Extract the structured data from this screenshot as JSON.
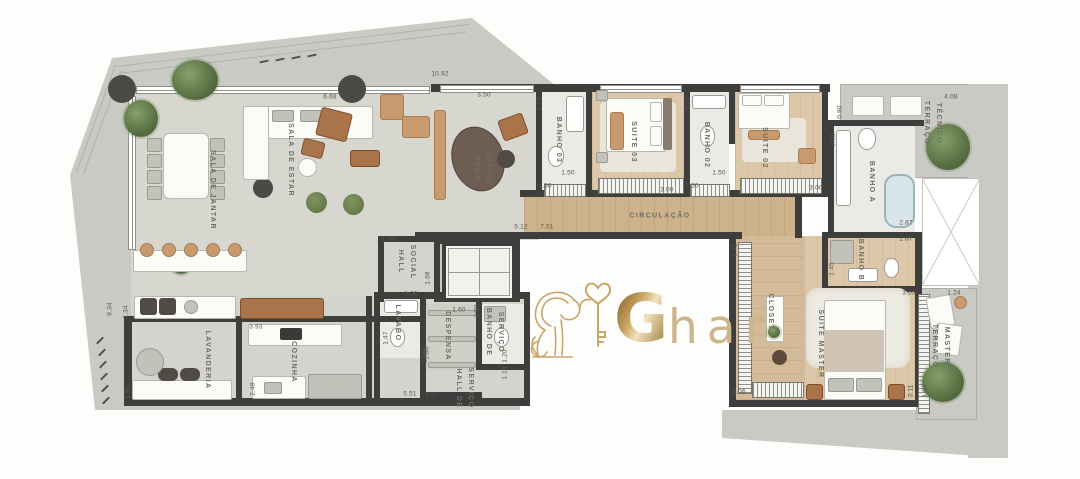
{
  "watermark": {
    "brand_g": "G",
    "brand_suffix": "har",
    "gold": "#c9a566"
  },
  "colors": {
    "wall": "#3e3e3c",
    "terrace": "#c9cac3",
    "floor": "#d7d7d0",
    "wood": "#cdb28b",
    "bath": "#eaeae6"
  },
  "rooms": {
    "sala_jantar": "SALA DE JANTAR",
    "sala_estar": "SALA DE ESTAR",
    "home_office": "HOME\nOFFICE",
    "banho_03": "BANHO 03",
    "suite_03": "SUITE 03",
    "banho_02": "BANHO 02",
    "suite_02": "SUITE 02",
    "circulacao": "CIRCULAÇÃO",
    "terraco_tecnico": "TERRAÇO\nTÉCNICO",
    "banho_a": "BANHO A",
    "banho_b": "BANHO B",
    "closet": "CLOSET",
    "suite_master": "SUITE MASTER",
    "terraco_master": "TERRAÇO\nMASTER",
    "hall_social": "HALL\nSOCIAL",
    "lavabo": "LAVABO",
    "lavanderia": "LAVANDERIA",
    "cozinha": "COZINHA",
    "despensa": "DESPENSA",
    "banho_servico": "BANHO DE\nSERVIÇO",
    "hall_servico": "HALL DE\nSERVIÇO"
  },
  "dims": {
    "d01": "10.92",
    "d02": "6.68",
    "d03": "3.50",
    "d04": "2.72",
    "d05": "2.72",
    "d06": "1.50",
    "d07": "1.50",
    "d08": "3.00",
    "d09": "1.50",
    "d10": "1.50",
    "d11": "3.00",
    "d12": "5.12",
    "d13": "7.51",
    "d14": "5.41",
    "d15": "3.31",
    "d16": "0.90",
    "d17": "4.08",
    "d18": "2.87",
    "d19": "2.87",
    "d20": "1.45",
    "d21": "6.06",
    "d22": "3.05",
    "d23": "1.24",
    "d24": "3.11",
    "d25": "1.64",
    "d26": "9.34",
    "d27": "1.34",
    "d28": "1.81",
    "d29": "3.93",
    "d30": "2.48",
    "d31": "1.20",
    "d32": "1.47",
    "d33": "1.90",
    "d34": "1.75",
    "d35": "1.68",
    "d36": "1.60",
    "d37": "1.80",
    "d38": "1.88",
    "d39": "5.51",
    "d40": "2.97",
    "d41": "1.10",
    "d42": "1.20"
  }
}
